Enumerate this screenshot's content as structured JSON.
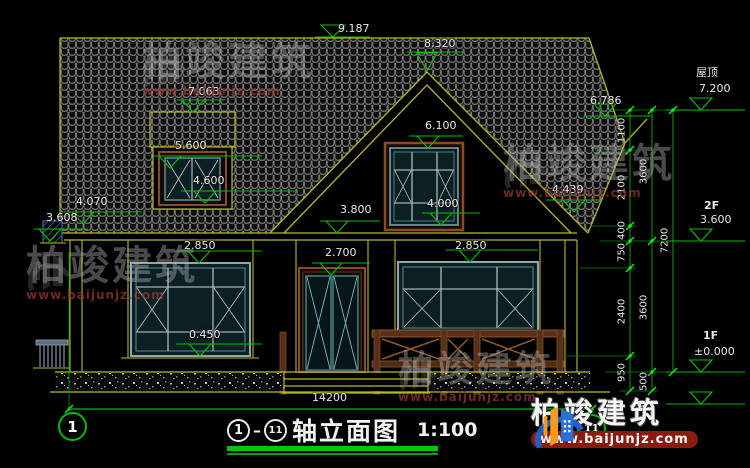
{
  "watermark": {
    "brand": "柏竣建筑",
    "url": "www.baijunjz.com"
  },
  "title_bar": {
    "axis_start": "1",
    "axis_end": "11",
    "name": "轴立面图",
    "scale": "1:100"
  },
  "levels": {
    "ridge": "9.187",
    "gable_peak": "8.320",
    "dormer_top": "7.063",
    "dormer_win_top": "5.600",
    "dormer_sill": "4.600",
    "left_eave": "4.070",
    "left_low": "3.608",
    "right_eave": "6.786",
    "right_eave2": "4.439",
    "gable_win_top": "6.100",
    "gable_sill": "4.000",
    "eave_2f": "3.800",
    "win1_top": "2.850",
    "door_top": "2.700",
    "win2_top": "2.850",
    "sill_1f": "0.450"
  },
  "floor_labels": {
    "roof": "屋顶",
    "roof_level": "7.200",
    "f2": "2F",
    "f2_level": "3.600",
    "f1": "1F",
    "f1_level": "±0.000"
  },
  "dims_vertical": {
    "a1": "1100",
    "a2": "2100",
    "a3": "400",
    "a4": "750",
    "a5": "2400",
    "a6": "950",
    "b1": "3600",
    "b2": "3600",
    "b3": "500",
    "c1": "7200"
  },
  "dims_horizontal": {
    "total": "14200"
  }
}
